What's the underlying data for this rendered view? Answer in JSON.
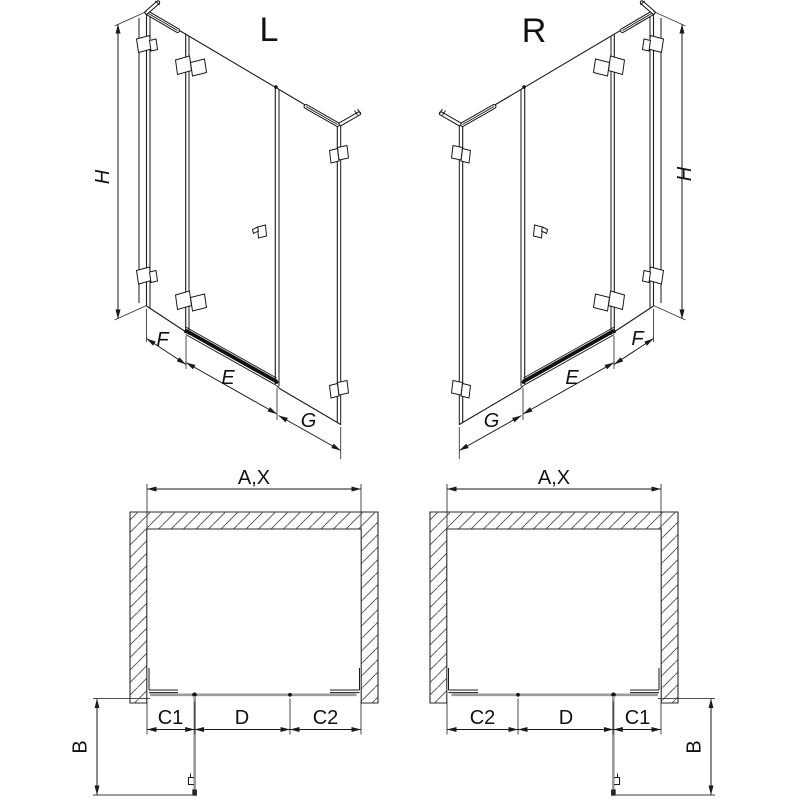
{
  "views": {
    "iso_left": {
      "label": "L",
      "height_dim": "H",
      "bottom_dims": [
        "F",
        "E",
        "G"
      ]
    },
    "iso_right": {
      "label": "R",
      "height_dim": "H",
      "bottom_dims": [
        "G",
        "E",
        "F"
      ]
    },
    "plan_left": {
      "width_dim": "A,X",
      "front_dims": [
        "C1",
        "D",
        "C2"
      ],
      "depth_dim": "B"
    },
    "plan_right": {
      "width_dim": "A,X",
      "front_dims": [
        "C2",
        "D",
        "C1"
      ],
      "depth_dim": "B"
    }
  },
  "colors": {
    "line": "#1a1a1a",
    "glass_gray": "#9b9b9b",
    "background": "#ffffff"
  }
}
